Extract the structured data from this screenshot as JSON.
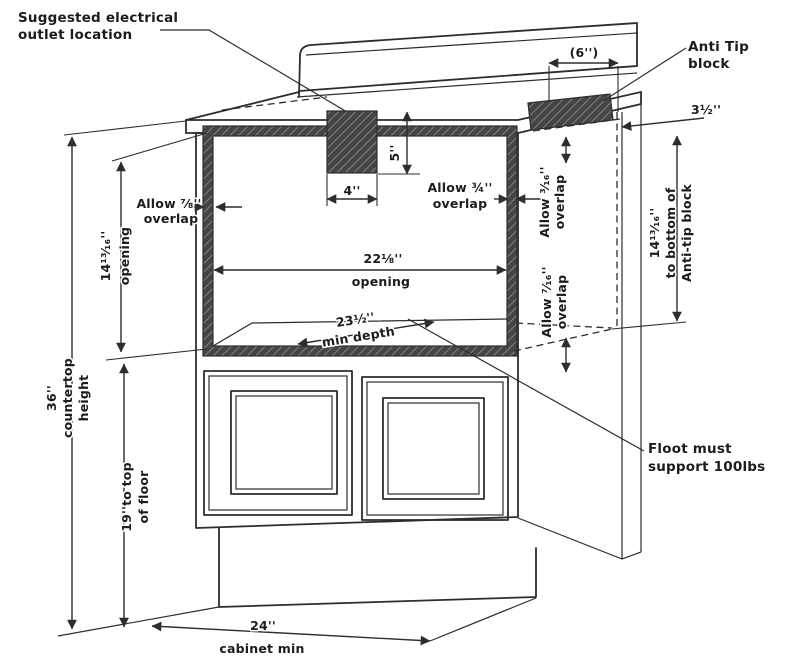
{
  "colors": {
    "ink": "#2d2d2d",
    "hatch_fill": "#454545",
    "hatch_line": "#909090",
    "background": "#ffffff"
  },
  "labels": {
    "electrical_outlet": {
      "line1": "Suggested electrical",
      "line2": "outlet location"
    },
    "anti_tip": {
      "line1": "Anti Tip",
      "line2": "block"
    },
    "dim_block_width": "(6'')",
    "dim_overhang": "3½''",
    "allow_left": {
      "line1": "Allow ⅞''",
      "line2": "overlap"
    },
    "allow_right": {
      "line1": "Allow ¾''",
      "line2": "overlap"
    },
    "allow_top_side": {
      "line1": "Allow ³⁄₁₆''",
      "line2": "overlap"
    },
    "allow_bottom_side": {
      "line1": "Allow ⁷⁄₁₆''",
      "line2": "overlap"
    },
    "opening_height": {
      "line1": "14¹³⁄₁₆''",
      "line2": "opening"
    },
    "opening_width": {
      "line1": "22⅛''",
      "line2": "opening"
    },
    "min_depth": {
      "line1": "23½''",
      "line2": "min depth"
    },
    "dim_outlet_width": "4''",
    "dim_outlet_height": "5''",
    "anti_tip_height": {
      "line1": "14¹³⁄₁₆''",
      "line2": "to bottom of",
      "line3": "Anti-tip block"
    },
    "countertop_height": {
      "line1": "36''",
      "line2": "countertop",
      "line3": "height"
    },
    "floor_height": {
      "line1": "19''to top",
      "line2": "of floor"
    },
    "floor_support": {
      "line1": "Floot must",
      "line2": "support 100lbs"
    },
    "cabinet_min": {
      "line1": "24''",
      "line2": "cabinet min"
    }
  }
}
